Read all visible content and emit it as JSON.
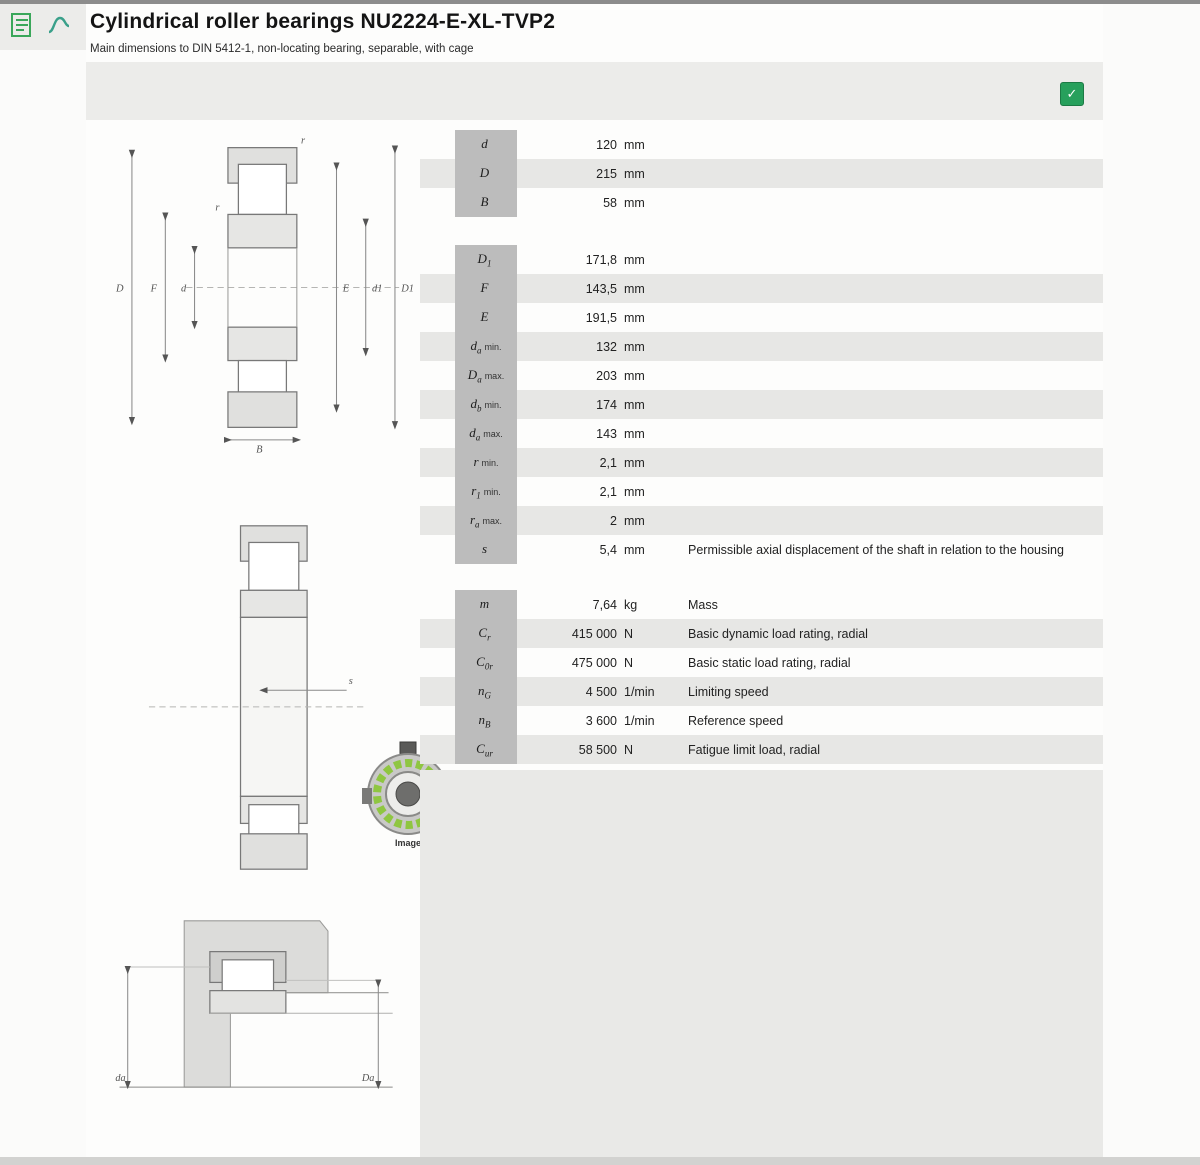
{
  "page": {
    "title": "Cylindrical roller bearings NU2224-E-XL-TVP2",
    "subtitle": "Main dimensions to DIN 5412-1, non-locating bearing, separable, with cage",
    "image_caption": "Image"
  },
  "toolbar": {
    "download_glyph": "✓"
  },
  "colors": {
    "accent_green": "#27a05c",
    "stripe": "#e7e7e5",
    "label_box": "#bcbcbc"
  },
  "drawing_labels": {
    "D": "D",
    "d": "d",
    "F": "F",
    "E": "E",
    "d1": "d1",
    "D1": "D1",
    "r": "r",
    "B": "B",
    "s": "s",
    "da": "da",
    "Da": "Da"
  },
  "sections": {
    "main": {
      "rows": [
        {
          "sym": "d",
          "sub": "",
          "suffix": "",
          "value": "120",
          "unit": "mm",
          "desc": ""
        },
        {
          "sym": "D",
          "sub": "",
          "suffix": "",
          "value": "215",
          "unit": "mm",
          "desc": ""
        },
        {
          "sym": "B",
          "sub": "",
          "suffix": "",
          "value": "58",
          "unit": "mm",
          "desc": ""
        }
      ]
    },
    "detail": {
      "rows": [
        {
          "sym": "D",
          "sub": "1",
          "suffix": "",
          "value": "171,8",
          "unit": "mm",
          "desc": ""
        },
        {
          "sym": "F",
          "sub": "",
          "suffix": "",
          "value": "143,5",
          "unit": "mm",
          "desc": ""
        },
        {
          "sym": "E",
          "sub": "",
          "suffix": "",
          "value": "191,5",
          "unit": "mm",
          "desc": ""
        },
        {
          "sym": "d",
          "sub": "a",
          "suffix": "min.",
          "value": "132",
          "unit": "mm",
          "desc": ""
        },
        {
          "sym": "D",
          "sub": "a",
          "suffix": "max.",
          "value": "203",
          "unit": "mm",
          "desc": ""
        },
        {
          "sym": "d",
          "sub": "b",
          "suffix": "min.",
          "value": "174",
          "unit": "mm",
          "desc": ""
        },
        {
          "sym": "d",
          "sub": "a",
          "suffix": "max.",
          "value": "143",
          "unit": "mm",
          "desc": ""
        },
        {
          "sym": "r",
          "sub": "",
          "suffix": "min.",
          "value": "2,1",
          "unit": "mm",
          "desc": ""
        },
        {
          "sym": "r",
          "sub": "1",
          "suffix": "min.",
          "value": "2,1",
          "unit": "mm",
          "desc": ""
        },
        {
          "sym": "r",
          "sub": "a",
          "suffix": "max.",
          "value": "2",
          "unit": "mm",
          "desc": ""
        },
        {
          "sym": "s",
          "sub": "",
          "suffix": "",
          "value": "5,4",
          "unit": "mm",
          "desc": "Permissible axial displacement of the shaft in relation to the housing"
        }
      ]
    },
    "performance": {
      "rows": [
        {
          "sym": "m",
          "sub": "",
          "suffix": "",
          "value": "7,64",
          "unit": "kg",
          "desc": "Mass"
        },
        {
          "sym": "C",
          "sub": "r",
          "suffix": "",
          "value": "415 000",
          "unit": "N",
          "desc": "Basic dynamic load rating, radial"
        },
        {
          "sym": "C",
          "sub": "0r",
          "suffix": "",
          "value": "475 000",
          "unit": "N",
          "desc": "Basic static load rating, radial"
        },
        {
          "sym": "n",
          "sub": "G",
          "suffix": "",
          "value": "4 500",
          "unit": "1/min",
          "desc": "Limiting speed"
        },
        {
          "sym": "n",
          "sub": "B",
          "suffix": "",
          "value": "3 600",
          "unit": "1/min",
          "desc": "Reference speed"
        },
        {
          "sym": "C",
          "sub": "ur",
          "suffix": "",
          "value": "58 500",
          "unit": "N",
          "desc": "Fatigue limit load, radial"
        }
      ]
    }
  }
}
